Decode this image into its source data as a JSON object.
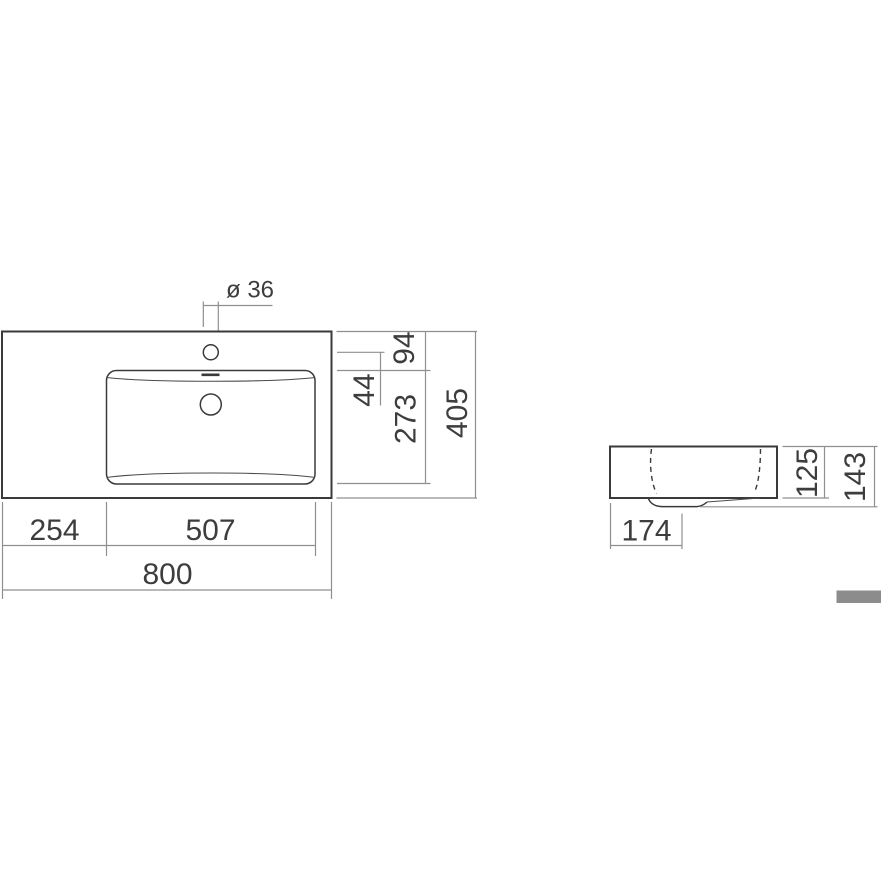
{
  "colors": {
    "outline": "#3a3a3a",
    "dimension_line": "#8f8f8f",
    "text": "#3d3d3d",
    "footer_bar": "#8c8c8c"
  },
  "top_view": {
    "hole_diameter_label": "ø 36",
    "edge_to_basin_depth": "94",
    "faucet_to_basin_gap": "44",
    "basin_inner_depth": "273",
    "overall_depth": "405",
    "left_section_width": "254",
    "basin_inner_width": "507",
    "overall_width": "800"
  },
  "side_view": {
    "body_height": "125",
    "overall_height": "143",
    "drain_offset": "174"
  }
}
